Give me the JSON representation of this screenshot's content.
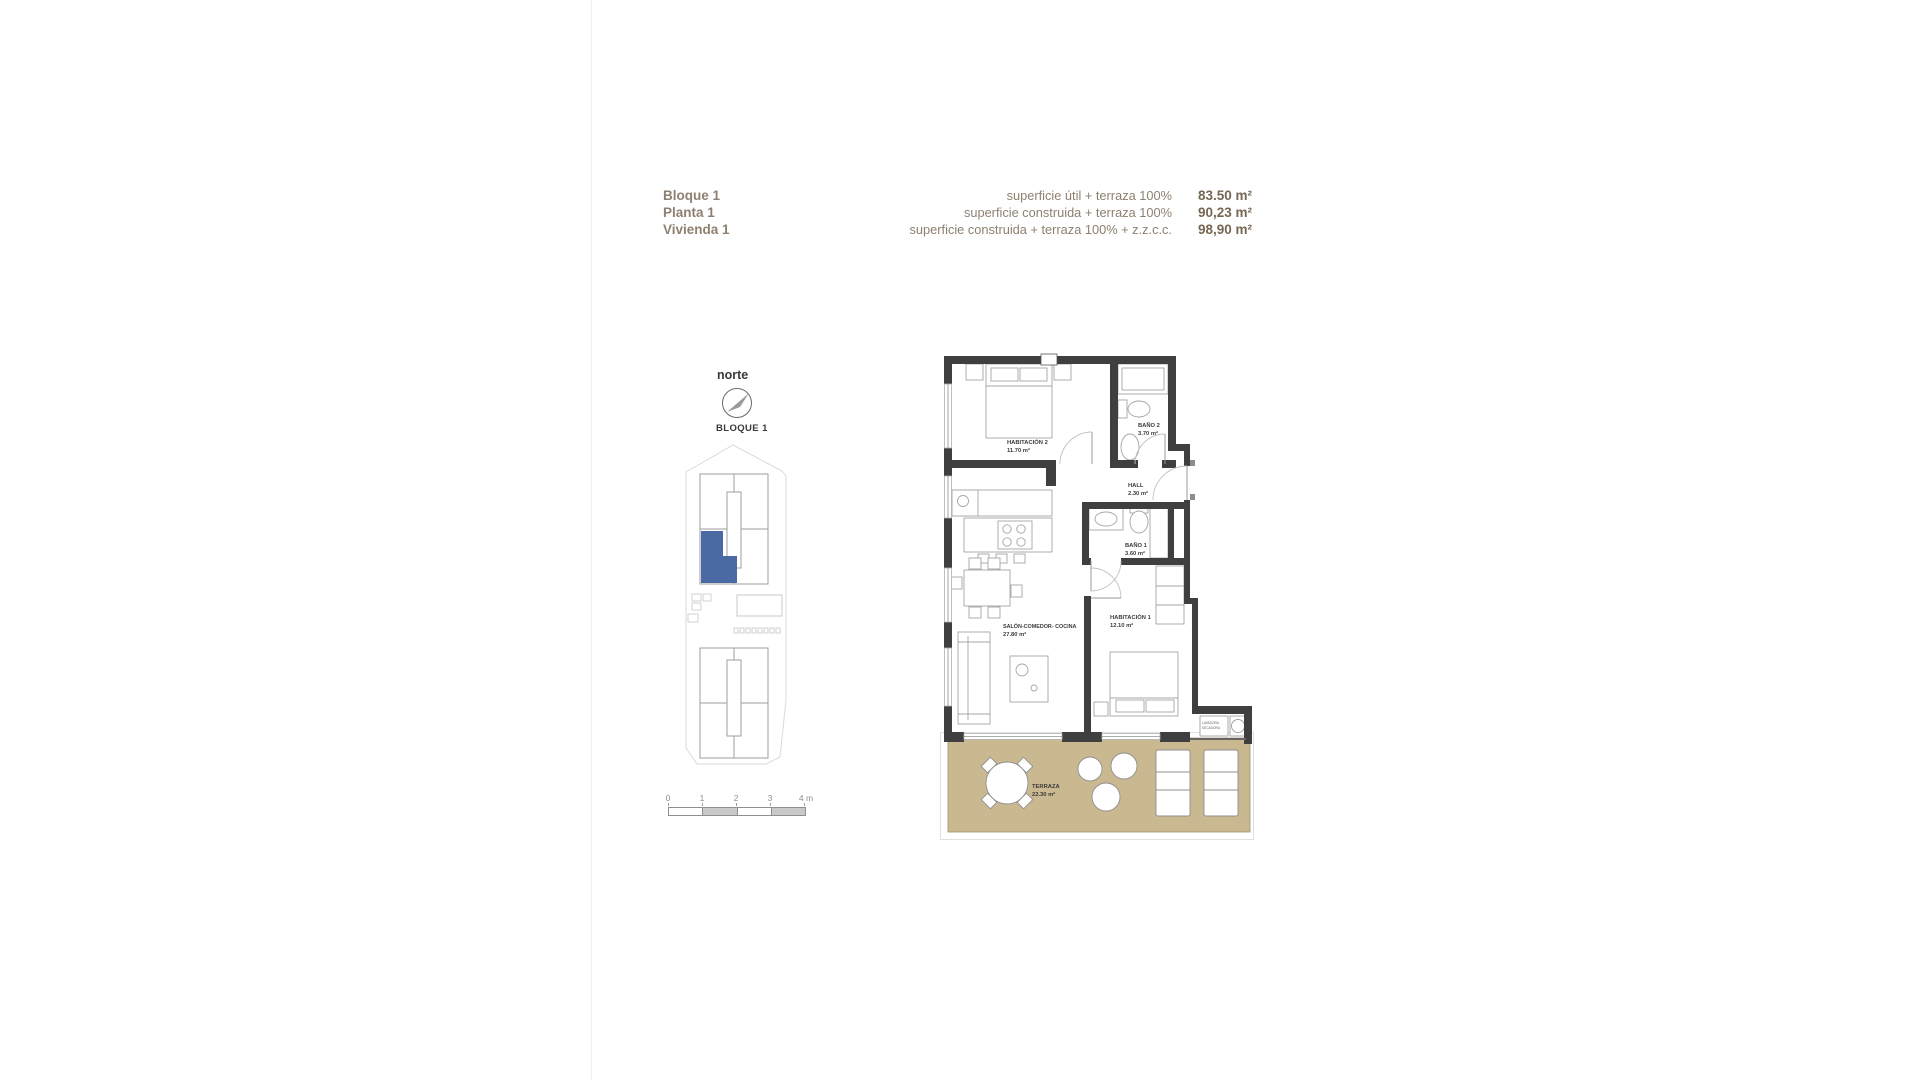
{
  "header": {
    "left": [
      "Bloque 1",
      "Planta 1",
      "Vivienda 1"
    ],
    "rows": [
      {
        "label": "superficie útil + terraza 100%",
        "value": "83.50 m²"
      },
      {
        "label": "superficie construida + terraza 100%",
        "value": "90,23 m²"
      },
      {
        "label": "superficie construida + terraza 100% + z.z.c.c.",
        "value": "98,90 m²"
      }
    ],
    "label_color": "#8e8071",
    "value_color": "#746753"
  },
  "north": {
    "label": "norte"
  },
  "site_plan": {
    "title": "BLOQUE 1",
    "highlight_color": "#4b69a3"
  },
  "scale_bar": {
    "ticks": [
      "0",
      "1",
      "2",
      "3",
      "4 m"
    ]
  },
  "floor_plan": {
    "wall_color": "#3f3f3f",
    "terrace_color": "#c9b890",
    "rooms": [
      {
        "name": "HABITACIÓN 2",
        "area": "11.70 m²"
      },
      {
        "name": "BAÑO 2",
        "area": "3.70 m²"
      },
      {
        "name": "HALL",
        "area": "2.30 m²"
      },
      {
        "name": "BAÑO 1",
        "area": "3.60 m²"
      },
      {
        "name": "SALÓN-COMEDOR- COCINA",
        "area": "27.80 m²"
      },
      {
        "name": "HABITACIÓN 1",
        "area": "12.10 m²"
      },
      {
        "name": "TERRAZA",
        "area": "22.30 m²"
      }
    ],
    "utility": {
      "line1": "LAVADORA",
      "line2": "SECADORA"
    }
  }
}
